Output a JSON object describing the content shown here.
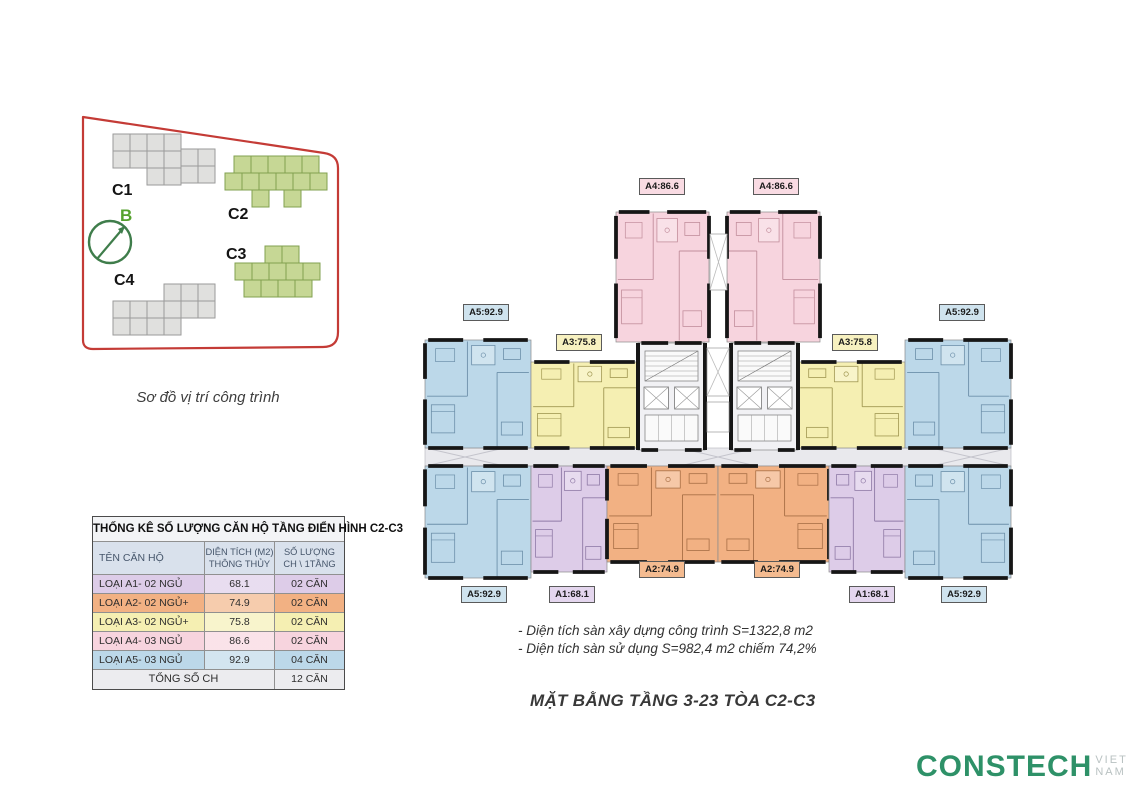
{
  "site_map": {
    "caption": "Sơ đồ vị trí công trình",
    "compass_label": "B",
    "buildings": [
      {
        "id": "C1",
        "type": "gray"
      },
      {
        "id": "C2",
        "type": "green"
      },
      {
        "id": "C3",
        "type": "green"
      },
      {
        "id": "C4",
        "type": "gray"
      }
    ]
  },
  "stats_table": {
    "title": "THỐNG KÊ SỐ LƯỢNG CĂN HỘ TẦNG ĐIỂN HÌNH C2-C3",
    "columns": {
      "name": "TÊN CĂN HỘ",
      "area_line1": "DIỆN TÍCH (M2)",
      "area_line2": "THÔNG THỦY",
      "count_line1": "SỐ LƯỢNG",
      "count_line2": "CH \\ 1TẦNG"
    },
    "rows": [
      {
        "name": "LOẠI A1- 02 NGỦ",
        "area": "68.1",
        "count": "02 CĂN",
        "type": "a1"
      },
      {
        "name": "LOẠI A2- 02 NGỦ+",
        "area": "74.9",
        "count": "02 CĂN",
        "type": "a2"
      },
      {
        "name": "LOẠI A3- 02 NGỦ+",
        "area": "75.8",
        "count": "02 CĂN",
        "type": "a3"
      },
      {
        "name": "LOẠI A4- 03 NGỦ",
        "area": "86.6",
        "count": "02 CĂN",
        "type": "a4"
      },
      {
        "name": "LOẠI A5- 03 NGỦ",
        "area": "92.9",
        "count": "04 CĂN",
        "type": "a5"
      }
    ],
    "total_label": "TỔNG SỐ CH",
    "total_count": "12 CĂN"
  },
  "floor_plan": {
    "unit_labels": [
      {
        "text": "A4:86.6",
        "type": "a4"
      },
      {
        "text": "A4:86.6",
        "type": "a4"
      },
      {
        "text": "A5:92.9",
        "type": "a5"
      },
      {
        "text": "A5:92.9",
        "type": "a5"
      },
      {
        "text": "A3:75.8",
        "type": "a3"
      },
      {
        "text": "A3:75.8",
        "type": "a3"
      },
      {
        "text": "A2:74.9",
        "type": "a2"
      },
      {
        "text": "A2:74.9",
        "type": "a2"
      },
      {
        "text": "A1:68.1",
        "type": "a1"
      },
      {
        "text": "A1:68.1",
        "type": "a1"
      },
      {
        "text": "A5:92.9",
        "type": "a5"
      },
      {
        "text": "A5:92.9",
        "type": "a5"
      }
    ],
    "notes": [
      "- Diện tích sàn xây dựng công trình S=1322,8 m2",
      "- Diện tích sàn sử dụng S=982,4 m2 chiếm 74,2%"
    ],
    "title": "MẶT BẰNG TẦNG 3-23 TÒA C2-C3"
  },
  "logo": {
    "brand": "CONSTECH",
    "suffix": "VIET NAM"
  },
  "palette": {
    "a1": "#ddcce8",
    "a2": "#f2b183",
    "a3": "#f5efb2",
    "a4": "#f7d4de",
    "a5": "#bcd8e9",
    "a1_line": "#8f7aa6",
    "a2_line": "#a86f46",
    "a3_line": "#a09751",
    "a4_line": "#c28e9c",
    "a5_line": "#6d90aa",
    "a1_label": "#e4d6ee",
    "a2_label": "#f4bb90",
    "a3_label": "#f7f1c0",
    "a4_label": "#f9dbe3",
    "a5_label": "#cfe3ee",
    "wall": "#161616",
    "core_fill": "#f1f1f4",
    "corridor_fill": "#e9e9ed",
    "site_green": "#c6d795",
    "site_green_line": "#82a050",
    "site_gray": "#e0e0de",
    "site_gray_line": "#9a9a9a",
    "boundary_red": "#c43b36",
    "compass_green": "#3f7d4b",
    "b_green": "#55a22d",
    "logo_green": "#2e9168",
    "logo_gray": "#b9c2c2"
  }
}
